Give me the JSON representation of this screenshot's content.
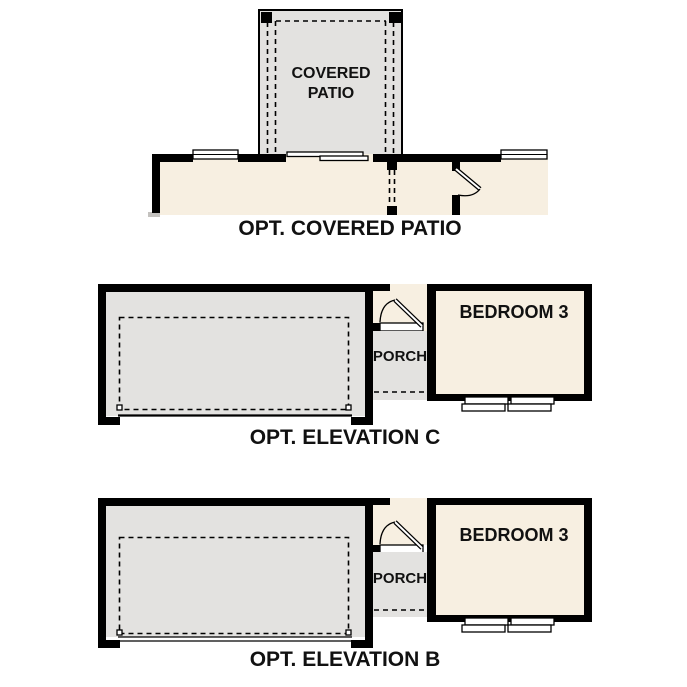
{
  "colors": {
    "wall": "#000000",
    "roof_fill": "#e3e2e0",
    "interior_fill": "#f7efe1",
    "window_fill": "#ffffff",
    "label_text": "#111111"
  },
  "covered_patio_plan": {
    "room_label": "COVERED PATIO",
    "caption": "OPT. COVERED PATIO"
  },
  "elevation_c_plan": {
    "porch_label": "PORCH",
    "bedroom_label": "BEDROOM 3",
    "caption": "OPT. ELEVATION C"
  },
  "elevation_b_plan": {
    "porch_label": "PORCH",
    "bedroom_label": "BEDROOM 3",
    "caption": "OPT. ELEVATION B"
  }
}
